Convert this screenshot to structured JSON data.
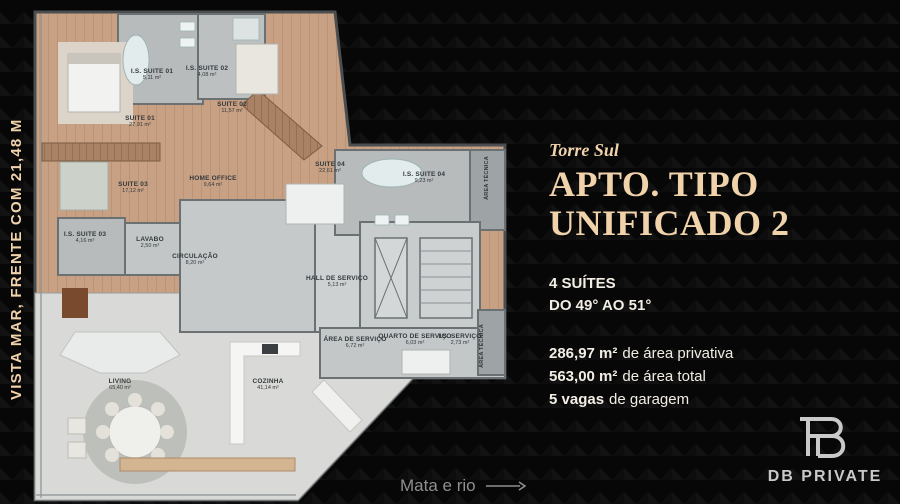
{
  "left_banner": {
    "text": "VISTA MAR, FRENTE COM 21,48 M"
  },
  "info": {
    "eyebrow": "Torre Sul",
    "title": "APTO. TIPO\nUNIFICADO 2",
    "subtitle_line1": "4 SUÍTES",
    "subtitle_line2": "DO 49° AO 51°",
    "specs": [
      {
        "value": "286,97 m²",
        "label": "de área privativa"
      },
      {
        "value": "563,00 m²",
        "label": "de área total"
      },
      {
        "value": "5 vagas",
        "label": "de garagem"
      }
    ]
  },
  "floor_plan": {
    "rooms": [
      {
        "label": "SUITE 01",
        "area": "27,91 m²",
        "x": 110,
        "y": 112,
        "vertical": false
      },
      {
        "label": "I.S. SUITE 01",
        "area": "5,11 m²",
        "x": 122,
        "y": 65,
        "vertical": false
      },
      {
        "label": "I.S. SUITE 02",
        "area": "4,08 m²",
        "x": 177,
        "y": 62,
        "vertical": false
      },
      {
        "label": "SUITE 02",
        "area": "11,57 m²",
        "x": 202,
        "y": 98,
        "vertical": false
      },
      {
        "label": "SUITE 03",
        "area": "17,12 m²",
        "x": 103,
        "y": 178,
        "vertical": false
      },
      {
        "label": "HOME OFFICE",
        "area": "9,64 m²",
        "x": 183,
        "y": 172,
        "vertical": false
      },
      {
        "label": "I.S. SUITE 03",
        "area": "4,16 m²",
        "x": 55,
        "y": 228,
        "vertical": false
      },
      {
        "label": "LAVABO",
        "area": "2,50 m²",
        "x": 120,
        "y": 233,
        "vertical": false
      },
      {
        "label": "CIRCULAÇÃO",
        "area": "8,20 m²",
        "x": 165,
        "y": 250,
        "vertical": false
      },
      {
        "label": "SUITE 04",
        "area": "22,61 m²",
        "x": 300,
        "y": 158,
        "vertical": false
      },
      {
        "label": "I.S. SUITE 04",
        "area": "9,23 m²",
        "x": 394,
        "y": 168,
        "vertical": false
      },
      {
        "label": "ÁREA TÉCNICA",
        "area": "",
        "x": 457,
        "y": 168,
        "vertical": true
      },
      {
        "label": "HALL DE SERVIÇO",
        "area": "5,13 m²",
        "x": 307,
        "y": 272,
        "vertical": false
      },
      {
        "label": "ÁREA DE SERVIÇO",
        "area": "6,72 m²",
        "x": 325,
        "y": 333,
        "vertical": false
      },
      {
        "label": "QUARTO DE SERVIÇO",
        "area": "6,03 m²",
        "x": 385,
        "y": 330,
        "vertical": false
      },
      {
        "label": "I.S. SERVIÇO",
        "area": "2,73 m²",
        "x": 430,
        "y": 330,
        "vertical": false
      },
      {
        "label": "ÁREA TÉCNICA",
        "area": "",
        "x": 452,
        "y": 336,
        "vertical": true
      },
      {
        "label": "LIVING",
        "area": "65,40 m²",
        "x": 90,
        "y": 375,
        "vertical": false
      },
      {
        "label": "COZINHA",
        "area": "41,14 m²",
        "x": 238,
        "y": 375,
        "vertical": false
      }
    ]
  },
  "footer": {
    "caption": "Mata e rio"
  },
  "brand": {
    "name": "DB PRIVATE"
  },
  "colors": {
    "accent_cream": "#f0d2ab",
    "background": "#070707",
    "wood_floor": "#c8a184",
    "tile_gray": "#b7bbbc",
    "muted_text": "#8f8f8f"
  }
}
